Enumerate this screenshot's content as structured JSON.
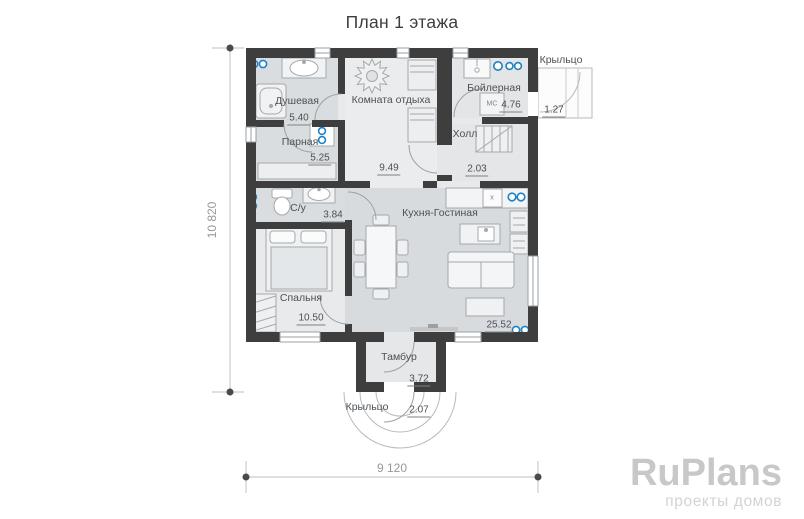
{
  "title": "План 1 этажа",
  "rooms": [
    {
      "name": "Душевая",
      "area": "5.40"
    },
    {
      "name": "Парная",
      "area": "5.25"
    },
    {
      "name": "Комната отдыха",
      "area": "9.49"
    },
    {
      "name": "Бойлерная",
      "area": "4.76"
    },
    {
      "name": "Крыльцо",
      "area": "1.27"
    },
    {
      "name": "Холл",
      "area": "2.03"
    },
    {
      "name": "С/у",
      "area": "3.84"
    },
    {
      "name": "Кухня-Гостиная",
      "area": "25.52"
    },
    {
      "name": "Спальня",
      "area": "10.50"
    },
    {
      "name": "Тамбур",
      "area": "3.72"
    },
    {
      "name": "Крыльцо",
      "area": "2.07"
    }
  ],
  "equipment_labels": {
    "boiler_unit": "МС",
    "kitchen_unit": "х"
  },
  "dimensions": {
    "vertical": "10 820",
    "horizontal": "9 120"
  },
  "watermark": {
    "brand": "RuPlans",
    "tagline": "проекты домов"
  },
  "colors": {
    "wall": "#3e3e3e",
    "accent_blue": "#1d83c5"
  }
}
